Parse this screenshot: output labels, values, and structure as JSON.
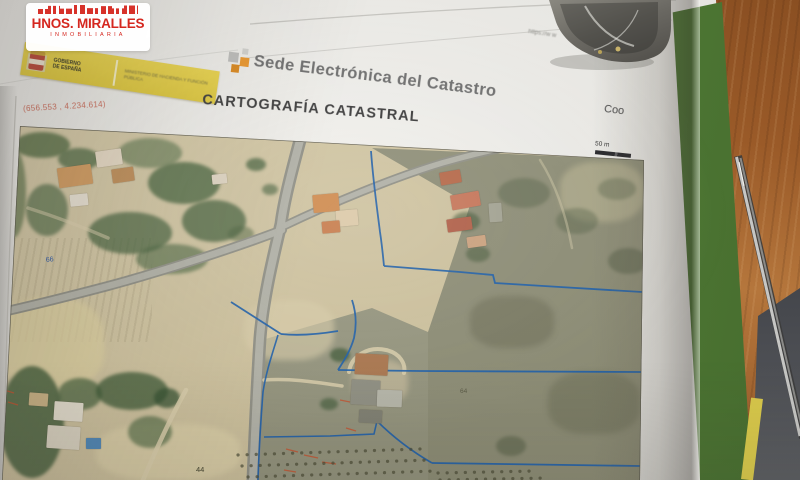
{
  "watermark": {
    "title": "HNOS. MIRALLES",
    "subtitle": "INMOBILIARIA",
    "brand_color": "#d5271f"
  },
  "header": {
    "gov_line1": "GOBIERNO",
    "gov_line2": "DE ESPAÑA",
    "ministry": "MINISTERIO DE HACIENDA Y FUNCIÓN PÚBLICA",
    "site_title": "Sede Electrónica del Catastro",
    "doc_title": "CARTOGRAFÍA CATASTRAL",
    "url_fragment": "https://w w",
    "right_text": "Coo",
    "logo_bg_color": "#e2cd48"
  },
  "map": {
    "coordinates": "(656.553 , 4.234.614)",
    "scale": "50 m",
    "labels": {
      "blue": "66",
      "faint": "64",
      "dark": "44"
    },
    "colors": {
      "parcel_boundary": "#2160a8",
      "survey_marks": "#c4502e",
      "roads": "#a6a69c"
    }
  }
}
